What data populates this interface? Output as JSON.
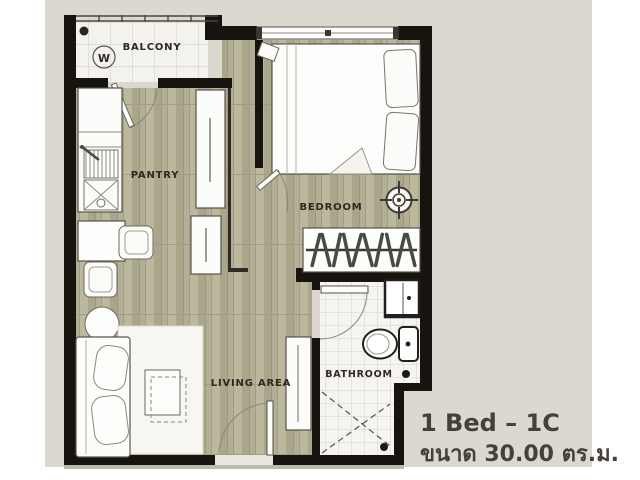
{
  "palette": {
    "panel_bg": "#dcd8d0",
    "wall": "#17130e",
    "wood_floor": "#b1ae93",
    "tile_floor": "#f3f2ed",
    "label_text": "#2d2922",
    "caption_text": "#46403a"
  },
  "rooms": {
    "balcony": {
      "label": "BALCONY"
    },
    "pantry": {
      "label": "PANTRY"
    },
    "bedroom": {
      "label": "BEDROOM"
    },
    "living_area": {
      "label": "LIVING AREA"
    },
    "bathroom": {
      "label": "BATHROOM"
    }
  },
  "fixtures": {
    "washer_label": "W"
  },
  "caption": {
    "unit_type": "1 Bed – 1C",
    "size_label": "ขนาด 30.00 ตร.ม."
  }
}
